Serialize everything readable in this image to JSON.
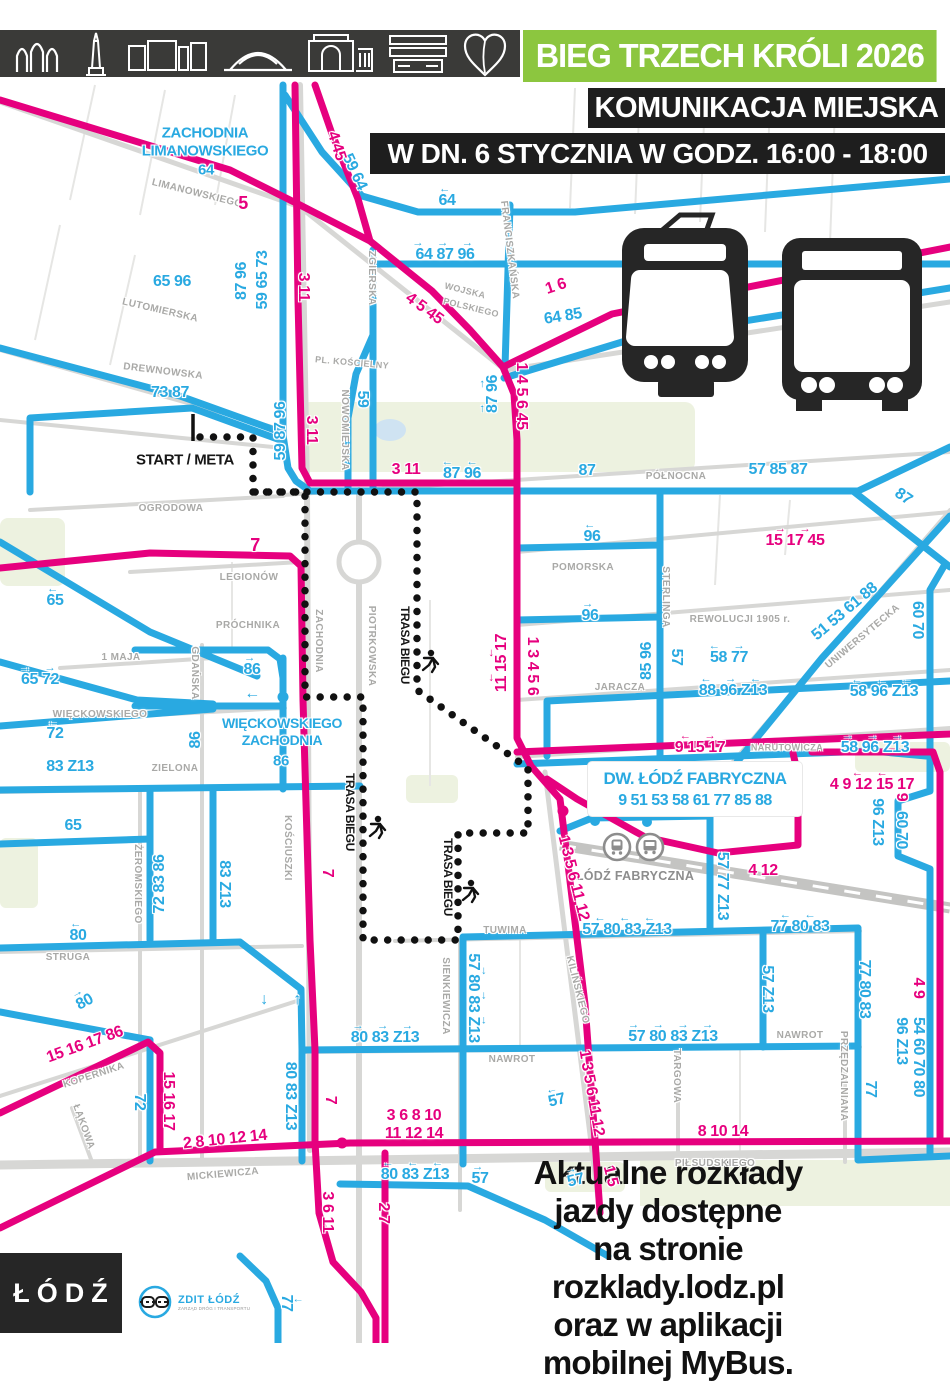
{
  "header": {
    "title": "BIEG TRZECH KRÓLI 2026",
    "line1": "KOMUNIKACJA MIEJSKA",
    "line2": "W DN. 6 STYCZNIA W GODZ. 16:00 - 18:00",
    "landmarks": [
      "gate-arches-icon",
      "monument-icon",
      "manufaktura-building-icon",
      "arena-dome-icon",
      "palace-icon",
      "library-slabs-icon",
      "heart-apple-icon"
    ]
  },
  "legend": {
    "tram_icon": "tram-silhouette",
    "bus_icon": "bus-silhouette"
  },
  "colors": {
    "tram_pink": "#E6007E",
    "bus_blue": "#29A9E1",
    "header_green": "#8CC63F",
    "box_black": "#1E1E1E",
    "bar_dark": "#3A3A38",
    "street_gray": "#D7D7D5",
    "course_black": "#111111"
  },
  "map": {
    "start_label": "START / META",
    "fabryczna_box": {
      "title": "DW. ŁÓDŹ FABRYCZNA",
      "routes": "9 51 53 58 61 77 85 88"
    },
    "station_label": "ŁÓDŹ FABRYCZNA",
    "black_labels": [
      {
        "t": "START / META",
        "x": 185,
        "y": 460,
        "s": 15
      },
      {
        "t": "TRASA BIEGU",
        "x": 405,
        "y": 645,
        "r": 90,
        "s": 12
      },
      {
        "t": "TRASA BIEGU",
        "x": 350,
        "y": 812,
        "r": 90,
        "s": 12
      },
      {
        "t": "TRASA BIEGU",
        "x": 448,
        "y": 877,
        "r": 90,
        "s": 12
      }
    ],
    "streets": [
      {
        "t": "LIMANOWSKIEGO",
        "x": 197,
        "y": 194,
        "r": 14
      },
      {
        "t": "LUTOMIERSKA",
        "x": 160,
        "y": 311,
        "r": 13
      },
      {
        "t": "DREWNOWSKA",
        "x": 163,
        "y": 372,
        "r": 7
      },
      {
        "t": "ZGIERSKA",
        "x": 371,
        "y": 278,
        "r": 90
      },
      {
        "t": "NOWOMIEJSKA",
        "x": 344,
        "y": 430,
        "r": 90
      },
      {
        "t": "PL. KOŚCIELNY",
        "x": 352,
        "y": 363,
        "r": 5,
        "s": 9
      },
      {
        "t": "FRANCISZKAŃSKA",
        "x": 509,
        "y": 250,
        "r": 83
      },
      {
        "t": "WOJSKA",
        "x": 465,
        "y": 291,
        "r": 14,
        "s": 9
      },
      {
        "t": "POLSKIEGO",
        "x": 471,
        "y": 308,
        "r": 14,
        "s": 9
      },
      {
        "t": "OGRODOWA",
        "x": 171,
        "y": 509
      },
      {
        "t": "PÓŁNOCNA",
        "x": 676,
        "y": 477
      },
      {
        "t": "POMORSKA",
        "x": 583,
        "y": 568
      },
      {
        "t": "LEGIONÓW",
        "x": 249,
        "y": 578
      },
      {
        "t": "PRÓCHNIKA",
        "x": 248,
        "y": 626
      },
      {
        "t": "1 MAJA",
        "x": 121,
        "y": 658
      },
      {
        "t": "GDAŃSKA",
        "x": 194,
        "y": 673,
        "r": 90
      },
      {
        "t": "ZACHODNIA",
        "x": 318,
        "y": 641,
        "r": 90
      },
      {
        "t": "PIOTRKOWSKA",
        "x": 371,
        "y": 646,
        "r": 90
      },
      {
        "t": "STERLINGA",
        "x": 665,
        "y": 597,
        "r": 90
      },
      {
        "t": "REWOLUCJI 1905 r.",
        "x": 740,
        "y": 620
      },
      {
        "t": "UNIWERSYTECKA",
        "x": 863,
        "y": 637,
        "r": -40
      },
      {
        "t": "JARACZA",
        "x": 620,
        "y": 688
      },
      {
        "t": "NARUTOWICZA",
        "x": 787,
        "y": 748,
        "s": 9
      },
      {
        "t": "WIĘCKOWSKIEGO",
        "x": 100,
        "y": 715
      },
      {
        "t": "ZIELONA",
        "x": 175,
        "y": 769
      },
      {
        "t": "ŻEROMSKIEGO",
        "x": 137,
        "y": 884,
        "r": 90
      },
      {
        "t": "KOŚCIUSZKI",
        "x": 287,
        "y": 848,
        "r": 90
      },
      {
        "t": "STRUGA",
        "x": 68,
        "y": 958
      },
      {
        "t": "TUWIMA",
        "x": 505,
        "y": 931
      },
      {
        "t": "SIENKIEWICZA",
        "x": 445,
        "y": 996,
        "r": 90
      },
      {
        "t": "KILIŃSKIEGO",
        "x": 577,
        "y": 990,
        "r": 76
      },
      {
        "t": "NAWROT",
        "x": 512,
        "y": 1060
      },
      {
        "t": "NAWROT",
        "x": 800,
        "y": 1036
      },
      {
        "t": "TARGOWA",
        "x": 676,
        "y": 1076,
        "r": 90
      },
      {
        "t": "PRZĘDZALNIANA",
        "x": 843,
        "y": 1076,
        "r": 90
      },
      {
        "t": "KOPERNIKA",
        "x": 94,
        "y": 1076,
        "r": -18
      },
      {
        "t": "ŁĄKOWA",
        "x": 83,
        "y": 1127,
        "r": 70
      },
      {
        "t": "MICKIEWICZA",
        "x": 223,
        "y": 1175,
        "r": -5
      },
      {
        "t": "PIŁSUDSKIEGO",
        "x": 715,
        "y": 1164
      }
    ],
    "tram_routes_pink": [
      {
        "t": "5",
        "x": 243,
        "y": 203,
        "s": 18
      },
      {
        "t": "4 45",
        "x": 336,
        "y": 146,
        "r": 72
      },
      {
        "t": "3 11",
        "x": 303,
        "y": 287,
        "r": 90
      },
      {
        "t": "3 11",
        "x": 311,
        "y": 430,
        "r": 90
      },
      {
        "t": "1 6",
        "x": 556,
        "y": 287,
        "r": -18
      },
      {
        "t": "4 5 45",
        "x": 424,
        "y": 309,
        "r": 36
      },
      {
        "t": "1 4 5 6 45",
        "x": 521,
        "y": 396,
        "r": 90
      },
      {
        "t": "3 11",
        "x": 406,
        "y": 470
      },
      {
        "t": "15 17 45",
        "x": 795,
        "y": 537,
        "a": "→ →"
      },
      {
        "t": "7",
        "x": 255,
        "y": 545,
        "s": 18
      },
      {
        "t": "11 15 17",
        "x": 498,
        "y": 663,
        "r": -90,
        "a": "← ←"
      },
      {
        "t": "1 3 4 5 6",
        "x": 532,
        "y": 666,
        "r": 90
      },
      {
        "t": "9 15 17",
        "x": 700,
        "y": 744,
        "a": "← →"
      },
      {
        "t": "4 9 12 15 17",
        "x": 872,
        "y": 781,
        "a": "  ← ←"
      },
      {
        "t": "9",
        "x": 901,
        "y": 797,
        "r": 90
      },
      {
        "t": "4 12",
        "x": 763,
        "y": 871
      },
      {
        "t": "1 3 5 6 11 12",
        "x": 573,
        "y": 878,
        "r": 76
      },
      {
        "t": "4 9",
        "x": 918,
        "y": 988,
        "r": 90
      },
      {
        "t": "1 3 5 6 11 12",
        "x": 591,
        "y": 1093,
        "r": 80
      },
      {
        "t": "15 16 17 86",
        "x": 85,
        "y": 1045,
        "r": -20
      },
      {
        "t": "15 16 17",
        "x": 168,
        "y": 1101,
        "r": 90
      },
      {
        "t": "2 8 10 12 14",
        "x": 225,
        "y": 1140,
        "r": -6
      },
      {
        "t": "3 6 8 10",
        "x": 414,
        "y": 1116
      },
      {
        "t": "11 12 14",
        "x": 414,
        "y": 1134
      },
      {
        "t": "8 10 14",
        "x": 723,
        "y": 1132
      },
      {
        "t": "1 5",
        "x": 610,
        "y": 1176,
        "r": 76
      },
      {
        "t": "3 6 11",
        "x": 327,
        "y": 1212,
        "r": 90
      },
      {
        "t": "2 7",
        "x": 383,
        "y": 1213,
        "r": 90
      },
      {
        "t": "7",
        "x": 327,
        "y": 873,
        "r": 90
      },
      {
        "t": "7",
        "x": 330,
        "y": 1100,
        "r": 90
      }
    ],
    "bus_routes_blue": [
      {
        "t": "ZACHODNIA",
        "x": 205,
        "y": 133,
        "s": 15
      },
      {
        "t": "LIMANOWSKIEGO",
        "x": 205,
        "y": 151,
        "s": 15
      },
      {
        "t": "64",
        "x": 206,
        "y": 170,
        "s": 15
      },
      {
        "t": "59 64",
        "x": 354,
        "y": 172,
        "r": 65
      },
      {
        "t": "64",
        "x": 447,
        "y": 197,
        "a": "←"
      },
      {
        "t": "64 87 96",
        "x": 445,
        "y": 251,
        "a": "→ → →"
      },
      {
        "t": "59 65 73",
        "x": 263,
        "y": 280,
        "r": -90
      },
      {
        "t": "87 96",
        "x": 242,
        "y": 281,
        "r": -90
      },
      {
        "t": "65 96",
        "x": 172,
        "y": 282
      },
      {
        "t": "73 87",
        "x": 170,
        "y": 393
      },
      {
        "t": "59 87 96",
        "x": 281,
        "y": 431,
        "r": -90
      },
      {
        "t": "59",
        "x": 362,
        "y": 399,
        "r": 90
      },
      {
        "t": "64 85",
        "x": 563,
        "y": 317,
        "r": -9
      },
      {
        "t": "87 96",
        "x": 489,
        "y": 394,
        "r": -90,
        "a": "→ →"
      },
      {
        "t": "87 96",
        "x": 462,
        "y": 470,
        "a": "← ←"
      },
      {
        "t": "87",
        "x": 587,
        "y": 471
      },
      {
        "t": "57 85 87",
        "x": 778,
        "y": 470
      },
      {
        "t": "87",
        "x": 903,
        "y": 497,
        "r": 35
      },
      {
        "t": "96",
        "x": 592,
        "y": 533,
        "a": "←"
      },
      {
        "t": "96",
        "x": 590,
        "y": 612,
        "a": "→"
      },
      {
        "t": "51 53 61 88",
        "x": 845,
        "y": 612,
        "r": -40
      },
      {
        "t": "60 70",
        "x": 917,
        "y": 620,
        "r": 90
      },
      {
        "t": "85 96",
        "x": 647,
        "y": 661,
        "r": -90
      },
      {
        "t": "57",
        "x": 676,
        "y": 657,
        "r": 90
      },
      {
        "t": "58 77",
        "x": 729,
        "y": 654,
        "a": "← →"
      },
      {
        "t": "88 96 Z13",
        "x": 733,
        "y": 687,
        "a": "← → ←"
      },
      {
        "t": "58 96 Z13",
        "x": 884,
        "y": 688,
        "a": "← ← ←"
      },
      {
        "t": "58 96 Z13",
        "x": 875,
        "y": 744,
        "a": "→ → →"
      },
      {
        "t": "65",
        "x": 55,
        "y": 597,
        "a": "←"
      },
      {
        "t": "65 72",
        "x": 40,
        "y": 676,
        "a": "→ →"
      },
      {
        "t": "72",
        "x": 55,
        "y": 730,
        "a": "←"
      },
      {
        "t": "83 Z13",
        "x": 70,
        "y": 767
      },
      {
        "t": "86",
        "x": 252,
        "y": 666,
        "a": "→"
      },
      {
        "t": "←",
        "x": 252,
        "y": 694
      },
      {
        "t": "WIĘCKOWSKIEGO",
        "x": 282,
        "y": 723,
        "s": 14
      },
      {
        "t": "ZACHODNIA",
        "x": 282,
        "y": 740,
        "s": 14
      },
      {
        "t": "86",
        "x": 281,
        "y": 761,
        "s": 15
      },
      {
        "t": "86",
        "x": 196,
        "y": 740,
        "r": -90
      },
      {
        "t": "65",
        "x": 73,
        "y": 826
      },
      {
        "t": "72 83 86",
        "x": 160,
        "y": 884,
        "r": -90
      },
      {
        "t": "83 Z13",
        "x": 224,
        "y": 884,
        "r": 90
      },
      {
        "t": "80",
        "x": 78,
        "y": 932,
        "a": "←"
      },
      {
        "t": "80",
        "x": 83,
        "y": 999,
        "r": -28,
        "a": "→"
      },
      {
        "t": "↓",
        "x": 264,
        "y": 1000
      },
      {
        "t": "↑",
        "x": 297,
        "y": 1000
      },
      {
        "t": "57 80 83 Z13",
        "x": 627,
        "y": 926,
        "a": "← ← ←"
      },
      {
        "t": "77 80 83",
        "x": 800,
        "y": 923,
        "a": " ← ←"
      },
      {
        "t": "57 77 Z13",
        "x": 722,
        "y": 886,
        "r": 90
      },
      {
        "t": "57 80 83 Z13",
        "x": 477,
        "y": 998,
        "r": 90,
        "a": "→ → →"
      },
      {
        "t": "80 83 Z13",
        "x": 385,
        "y": 1034,
        "a": "→ → →"
      },
      {
        "t": "57 80 83 Z13",
        "x": 673,
        "y": 1033,
        "a": "→ → → →"
      },
      {
        "t": "57 Z13",
        "x": 767,
        "y": 989,
        "r": 90
      },
      {
        "t": "77 80 83",
        "x": 864,
        "y": 989,
        "r": 90
      },
      {
        "t": "54 60 70 80",
        "x": 918,
        "y": 1057,
        "r": 90
      },
      {
        "t": "96 Z13",
        "x": 901,
        "y": 1041,
        "r": 90
      },
      {
        "t": "96 Z13",
        "x": 877,
        "y": 822,
        "r": 90
      },
      {
        "t": "60 70",
        "x": 901,
        "y": 830,
        "r": 90
      },
      {
        "t": "77",
        "x": 870,
        "y": 1089,
        "r": 90
      },
      {
        "t": "77",
        "x": 290,
        "y": 1303,
        "r": 90,
        "a": "↓"
      },
      {
        "t": "72",
        "x": 139,
        "y": 1102,
        "r": 90
      },
      {
        "t": "80 83 Z13",
        "x": 290,
        "y": 1096,
        "r": 90
      },
      {
        "t": "80 83 Z13",
        "x": 415,
        "y": 1171,
        "a": "← ← ←"
      },
      {
        "t": "57",
        "x": 556,
        "y": 1097,
        "r": -14,
        "a": "←"
      },
      {
        "t": "57",
        "x": 480,
        "y": 1175,
        "a": "→"
      },
      {
        "t": "57",
        "x": 575,
        "y": 1177,
        "r": -14,
        "a": "→"
      }
    ]
  },
  "footer": {
    "lines": [
      "Aktualne rozkłady jazdy dostępne",
      "na stronie rozklady.lodz.pl",
      "oraz w aplikacji mobilnej MyBus."
    ],
    "lodz_logo": "ŁÓDŹ",
    "zdit_logo": "ZDIT ŁÓDŹ",
    "zdit_sub": "ZARZĄD DRÓG I TRANSPORTU"
  }
}
